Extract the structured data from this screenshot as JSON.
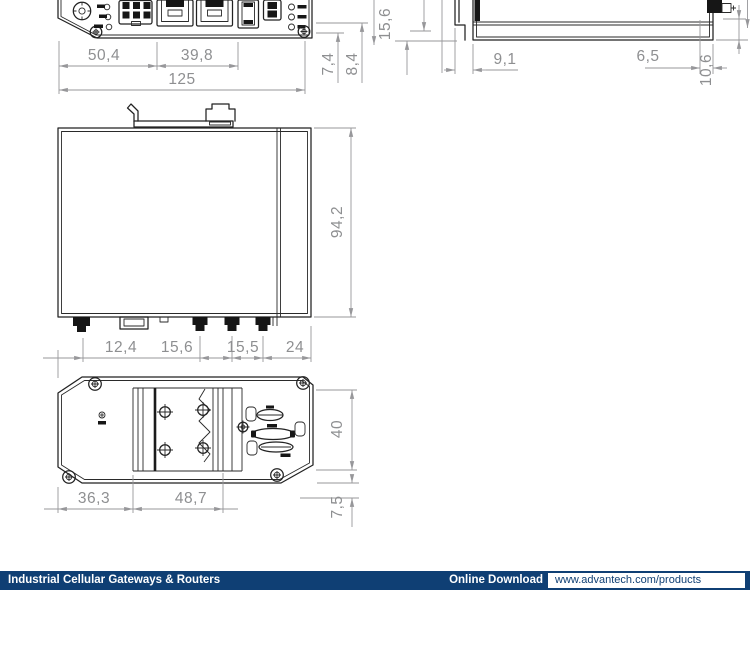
{
  "drawing": {
    "front_view": {
      "dim_50_4": "50,4",
      "dim_39_8": "39,8",
      "dim_125": "125",
      "dim_7_4": "7,4",
      "dim_8_4": "8,4",
      "dim_15_6": "15,6"
    },
    "side_view": {
      "dim_9_1": "9,1",
      "dim_6_5": "6,5",
      "dim_10_6": "10,6"
    },
    "top_view": {
      "dim_94_2": "94,2",
      "dim_12_4": "12,4",
      "dim_15_6": "15,6",
      "dim_15_5": "15,5",
      "dim_24": "24"
    },
    "bottom_view": {
      "dim_36_3": "36,3",
      "dim_48_7": "48,7",
      "dim_40": "40",
      "dim_7_5": "7,5"
    }
  },
  "footer": {
    "category": "Industrial Cellular Gateways & Routers",
    "download_label": "Online Download",
    "url": "www.advantech.com/products",
    "bar_color": "#0f3f74",
    "text_color": "#ffffff"
  }
}
